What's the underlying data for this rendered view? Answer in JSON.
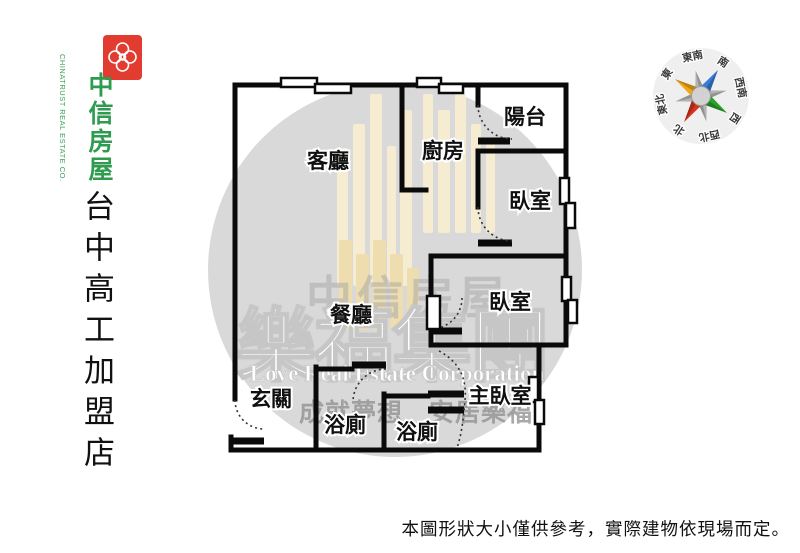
{
  "branding": {
    "company_zh": "中信房屋",
    "company_en": "CHINATRUST REAL ESTATE CO.",
    "store_name": "台中高工加盟店",
    "brand_green": "#2e9b4e",
    "brand_red": "#e23b30"
  },
  "floor_plan": {
    "rooms": [
      {
        "id": "living-room",
        "label": "客廳"
      },
      {
        "id": "kitchen",
        "label": "廚房"
      },
      {
        "id": "balcony",
        "label": "陽台"
      },
      {
        "id": "bedroom-1",
        "label": "臥室"
      },
      {
        "id": "bedroom-2",
        "label": "臥室"
      },
      {
        "id": "dining-room",
        "label": "餐廳"
      },
      {
        "id": "entry",
        "label": "玄關"
      },
      {
        "id": "bathroom-1",
        "label": "浴廁"
      },
      {
        "id": "bathroom-2",
        "label": "浴廁"
      },
      {
        "id": "master-bedroom",
        "label": "主臥室"
      }
    ]
  },
  "watermark": {
    "group_name_zh": "樂福集團",
    "group_name_en": "Love Real Estate Corporation",
    "slogan": "成就夢想　安居樂福",
    "brand_shadow": "中信房屋"
  },
  "compass": {
    "directions": [
      {
        "label": "東南"
      },
      {
        "label": "南"
      },
      {
        "label": "西南"
      },
      {
        "label": "西"
      },
      {
        "label": "西北"
      },
      {
        "label": "北"
      },
      {
        "label": "東北"
      },
      {
        "label": "東"
      }
    ],
    "north_color": "#cc1111",
    "point_colors": {
      "south": "#3a7bd5",
      "west": "#27a02c",
      "north": "#d8311f",
      "east": "#f0a818"
    }
  },
  "disclaimer": "本圖形狀大小僅供參考，實際建物依現場而定。"
}
